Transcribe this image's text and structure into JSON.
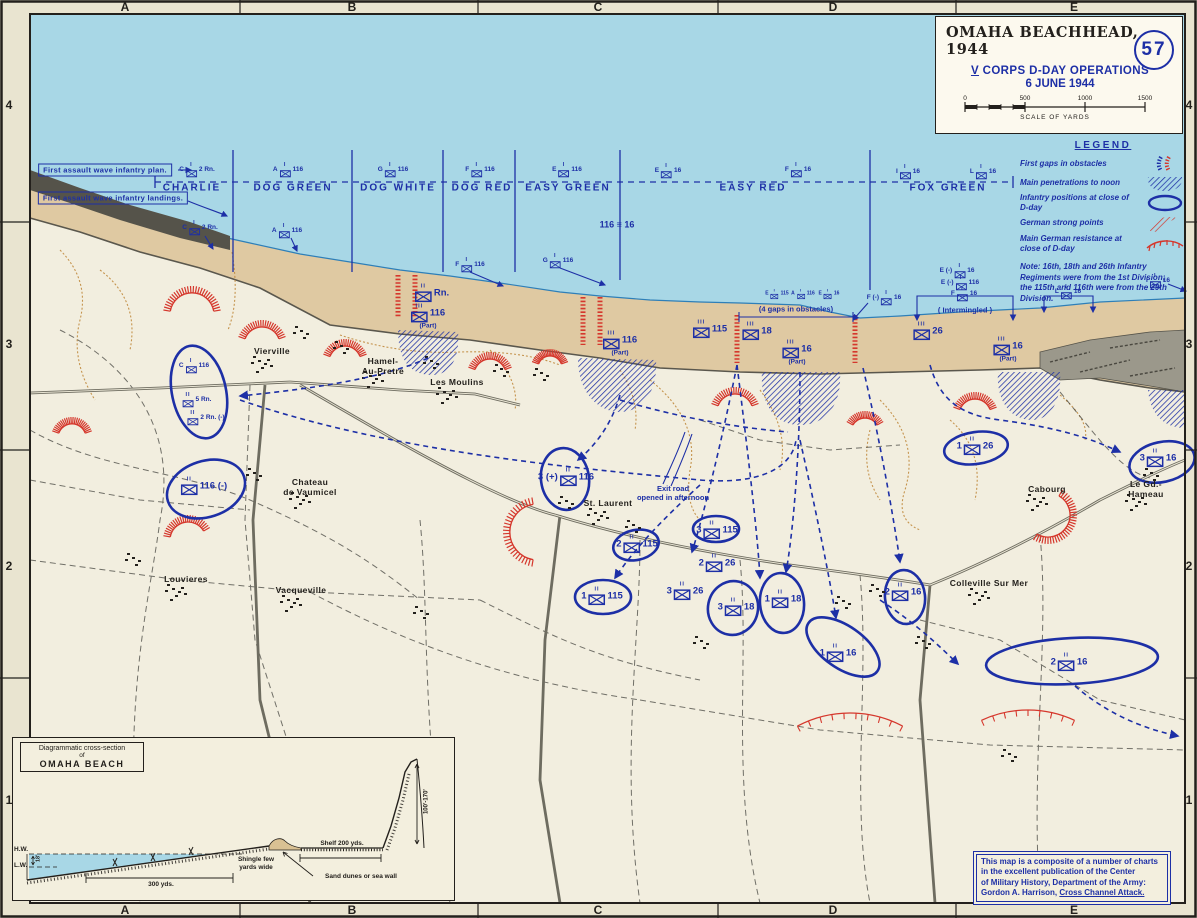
{
  "title_box": {
    "title": "OMAHA BEACHHEAD, 1944",
    "map_number": "57",
    "subtitle_v": "V",
    "subtitle_rest": " CORPS D-DAY OPERATIONS",
    "subtitle2": "6 JUNE 1944",
    "scale_ticks": [
      "0",
      "500",
      "1000",
      "1500"
    ],
    "scale_caption": "SCALE OF YARDS"
  },
  "legend": {
    "title": "LEGEND",
    "items": [
      {
        "label": "First gaps in obstacles",
        "symbol": "gap-icon"
      },
      {
        "label": "Main penetrations to noon",
        "symbol": "penetration-icon"
      },
      {
        "label": "Infantry positions at close of D-day",
        "symbol": "infantry-position-icon"
      },
      {
        "label": "German strong points",
        "symbol": "strongpoint-icon"
      },
      {
        "label": "Main German resistance at close of D-day",
        "symbol": "resistance-icon"
      }
    ],
    "note": "Note: 16th, 18th and 26th Infantry Regiments were from the 1st Division; the 115th and 116th were from the 29th Division."
  },
  "frame": {
    "grid_letters": [
      "A",
      "B",
      "C",
      "D",
      "E"
    ],
    "grid_letter_x": [
      125,
      352,
      598,
      833,
      1074
    ],
    "grid_numbers": [
      "4",
      "3",
      "2",
      "1"
    ],
    "grid_number_y": [
      105,
      344,
      566,
      800
    ]
  },
  "annotations": {
    "plan": {
      "text": "First assault wave infantry plan.",
      "x": 105,
      "y": 170
    },
    "landings": {
      "text": "First assault wave infantry landings.",
      "x": 113,
      "y": 198
    },
    "gaps": {
      "text": "(4 gaps in obstacles)",
      "x": 796,
      "y": 309
    },
    "intermingled": {
      "text": "( Intermingled )",
      "x": 965,
      "y": 310
    },
    "boundary_116_16": {
      "text": "116 ≡ 16",
      "x": 617,
      "y": 225
    },
    "exit_road": {
      "text": "Exit road\nopened in afternoon",
      "x": 673,
      "y": 493
    }
  },
  "sectors": {
    "label_y": 188,
    "items": [
      {
        "name": "CHARLIE",
        "x": 192
      },
      {
        "name": "DOG GREEN",
        "x": 293
      },
      {
        "name": "DOG WHITE",
        "x": 398
      },
      {
        "name": "DOG RED",
        "x": 482
      },
      {
        "name": "EASY GREEN",
        "x": 568
      },
      {
        "name": "EASY RED",
        "x": 753
      },
      {
        "name": "FOX GREEN",
        "x": 948
      }
    ],
    "boundaries": [
      233,
      352,
      443,
      515,
      620,
      870
    ]
  },
  "unit_markers": [
    {
      "x": 197,
      "y": 170,
      "l": "C",
      "r": "2 Rn.",
      "e": "I",
      "s": "sm"
    },
    {
      "x": 288,
      "y": 170,
      "l": "A",
      "r": "116",
      "e": "I",
      "s": "sm"
    },
    {
      "x": 393,
      "y": 170,
      "l": "G",
      "r": "116",
      "e": "I",
      "s": "sm"
    },
    {
      "x": 480,
      "y": 170,
      "l": "F",
      "r": "116",
      "e": "I",
      "s": "sm"
    },
    {
      "x": 567,
      "y": 170,
      "l": "E",
      "r": "116",
      "e": "I",
      "s": "sm"
    },
    {
      "x": 668,
      "y": 171,
      "l": "E",
      "r": "16",
      "e": "I",
      "s": "sm"
    },
    {
      "x": 798,
      "y": 170,
      "l": "F",
      "r": "16",
      "e": "I",
      "s": "sm"
    },
    {
      "x": 908,
      "y": 172,
      "l": "I",
      "r": "16",
      "e": "I",
      "s": "sm"
    },
    {
      "x": 983,
      "y": 172,
      "l": "L",
      "r": "16",
      "e": "I",
      "s": "sm"
    },
    {
      "x": 200,
      "y": 228,
      "l": "C",
      "r": "2 Rn.",
      "e": "I",
      "s": "sm"
    },
    {
      "x": 287,
      "y": 231,
      "l": "A",
      "r": "116",
      "e": "I",
      "s": "sm"
    },
    {
      "x": 470,
      "y": 265,
      "l": "F",
      "r": "116",
      "e": "I",
      "s": "sm"
    },
    {
      "x": 558,
      "y": 261,
      "l": "G",
      "r": "116",
      "e": "I",
      "s": "sm"
    },
    {
      "x": 777,
      "y": 294,
      "l": "E",
      "r": "115",
      "e": "I",
      "s": "xs"
    },
    {
      "x": 803,
      "y": 294,
      "l": "A",
      "r": "116",
      "e": "I",
      "s": "xs"
    },
    {
      "x": 829,
      "y": 294,
      "l": "E",
      "r": "16",
      "e": "I",
      "s": "xs"
    },
    {
      "x": 884,
      "y": 298,
      "l": "F (-)",
      "r": "16",
      "e": "I",
      "s": "sm"
    },
    {
      "x": 957,
      "y": 271,
      "l": "E (-)",
      "r": "16",
      "e": "I",
      "s": "sm"
    },
    {
      "x": 960,
      "y": 283,
      "l": "E (-)",
      "r": "116",
      "e": "I",
      "s": "sm"
    },
    {
      "x": 964,
      "y": 294,
      "l": "F",
      "r": "16",
      "e": "I",
      "s": "sm"
    },
    {
      "x": 1068,
      "y": 292,
      "l": "L",
      "r": "16",
      "e": "I",
      "s": "sm"
    },
    {
      "x": 1158,
      "y": 281,
      "l": "I",
      "r": "16",
      "e": "I",
      "s": "sm"
    },
    {
      "x": 432,
      "y": 293,
      "l": "",
      "r": "Rn.",
      "e": "II",
      "s": "md"
    },
    {
      "x": 428,
      "y": 317,
      "l": "",
      "r": "116",
      "e": "III",
      "sub": "(Part)",
      "s": "md"
    },
    {
      "x": 620,
      "y": 344,
      "l": "",
      "r": "116",
      "e": "III",
      "sub": "(Part)",
      "s": "md"
    },
    {
      "x": 710,
      "y": 329,
      "l": "",
      "r": "115",
      "e": "III",
      "s": "md"
    },
    {
      "x": 757,
      "y": 331,
      "l": "",
      "r": "18",
      "e": "III",
      "s": "md"
    },
    {
      "x": 797,
      "y": 353,
      "l": "",
      "r": "16",
      "e": "III",
      "sub": "(Part)",
      "s": "md"
    },
    {
      "x": 928,
      "y": 331,
      "l": "",
      "r": "26",
      "e": "III",
      "s": "md"
    },
    {
      "x": 1008,
      "y": 350,
      "l": "",
      "r": "16",
      "e": "III",
      "sub": "(Part)",
      "s": "md"
    },
    {
      "x": 717,
      "y": 563,
      "l": "2",
      "r": "26",
      "e": "II",
      "s": "md"
    },
    {
      "x": 685,
      "y": 591,
      "l": "3",
      "r": "26",
      "e": "II",
      "s": "md"
    }
  ],
  "ellipse_units": [
    {
      "x": 194,
      "y": 366,
      "l": "C",
      "r": "116",
      "e": "I",
      "s": "sm",
      "ellipse": {
        "cx": 199,
        "cy": 392,
        "rx": 27,
        "ry": 47,
        "rot": -12
      }
    },
    {
      "x": 197,
      "y": 400,
      "l": "",
      "r": "5 Rn.",
      "e": "II",
      "s": "sm"
    },
    {
      "x": 206,
      "y": 418,
      "l": "",
      "r": "2 Rn. (-)",
      "e": "II",
      "s": "sm"
    },
    {
      "x": 204,
      "y": 486,
      "l": "",
      "r": "116 (-)",
      "e": "II",
      "s": "md",
      "ellipse": {
        "cx": 206,
        "cy": 489,
        "rx": 40,
        "ry": 28,
        "rot": -18
      }
    },
    {
      "x": 566,
      "y": 477,
      "l": "3 (+)",
      "r": "116",
      "e": "II",
      "s": "md",
      "ellipse": {
        "cx": 565,
        "cy": 479,
        "rx": 24,
        "ry": 31,
        "rot": -8
      }
    },
    {
      "x": 637,
      "y": 544,
      "l": "2",
      "r": "115",
      "e": "II",
      "s": "md",
      "ellipse": {
        "cx": 636,
        "cy": 545,
        "rx": 23,
        "ry": 15,
        "rot": -12
      }
    },
    {
      "x": 602,
      "y": 596,
      "l": "1",
      "r": "115",
      "e": "II",
      "s": "md",
      "ellipse": {
        "cx": 603,
        "cy": 597,
        "rx": 28,
        "ry": 17,
        "rot": 0
      }
    },
    {
      "x": 717,
      "y": 530,
      "l": "3",
      "r": "115",
      "e": "II",
      "s": "md",
      "ellipse": {
        "cx": 716,
        "cy": 529,
        "rx": 23,
        "ry": 13,
        "rot": 0
      }
    },
    {
      "x": 736,
      "y": 607,
      "l": "3",
      "r": "18",
      "e": "II",
      "s": "md",
      "ellipse": {
        "cx": 733,
        "cy": 608,
        "rx": 25,
        "ry": 27,
        "rot": 12
      }
    },
    {
      "x": 783,
      "y": 599,
      "l": "1",
      "r": "18",
      "e": "II",
      "s": "md",
      "ellipse": {
        "cx": 782,
        "cy": 603,
        "rx": 22,
        "ry": 30,
        "rot": -5
      }
    },
    {
      "x": 838,
      "y": 653,
      "l": "1",
      "r": "16",
      "e": "II",
      "s": "md",
      "ellipse": {
        "cx": 843,
        "cy": 647,
        "rx": 42,
        "ry": 21,
        "rot": 35
      }
    },
    {
      "x": 903,
      "y": 592,
      "l": "2",
      "r": "16",
      "e": "II",
      "s": "md",
      "ellipse": {
        "cx": 905,
        "cy": 597,
        "rx": 20,
        "ry": 27,
        "rot": -6
      }
    },
    {
      "x": 975,
      "y": 446,
      "l": "1",
      "r": "26",
      "e": "II",
      "s": "md",
      "ellipse": {
        "cx": 976,
        "cy": 448,
        "rx": 32,
        "ry": 16,
        "rot": -8
      }
    },
    {
      "x": 1158,
      "y": 458,
      "l": "3",
      "r": "16",
      "e": "II",
      "s": "md",
      "ellipse": {
        "cx": 1162,
        "cy": 462,
        "rx": 33,
        "ry": 20,
        "rot": -12
      }
    },
    {
      "x": 1069,
      "y": 662,
      "l": "2",
      "r": "16",
      "e": "II",
      "s": "md",
      "ellipse": {
        "cx": 1072,
        "cy": 661,
        "rx": 86,
        "ry": 23,
        "rot": -3
      }
    }
  ],
  "towns": [
    {
      "name": "Vierville",
      "x": 272,
      "y": 352
    },
    {
      "name": "Hamel-\nAu-Pretre",
      "x": 383,
      "y": 367
    },
    {
      "name": "Les Moulins",
      "x": 457,
      "y": 383
    },
    {
      "name": "St. Laurent",
      "x": 608,
      "y": 504
    },
    {
      "name": "Chateau\nde Vaumicel",
      "x": 310,
      "y": 488
    },
    {
      "name": "Louvieres",
      "x": 186,
      "y": 580
    },
    {
      "name": "Vacqueville",
      "x": 301,
      "y": 591
    },
    {
      "name": "Colleville Sur Mer",
      "x": 989,
      "y": 584
    },
    {
      "name": "Cabourg",
      "x": 1047,
      "y": 490
    },
    {
      "name": "Le Gd.- Hameau",
      "x": 1146,
      "y": 490
    }
  ],
  "cross_section": {
    "box_line1": "Diagrammatic cross-section",
    "box_line2": "of",
    "box_line3": "OMAHA BEACH",
    "hw": "H.W.",
    "lw": "L.W.",
    "tide": "18'",
    "beach_width": "300 yds.",
    "shingle": "Shingle few yards wide",
    "dunes": "Sand dunes or sea wall",
    "shelf": "Shelf 200 yds.",
    "cliff": "100'-170'"
  },
  "source_note": {
    "line1": "This map is a composite of a number of charts",
    "line2": "in the excellent publication of the Center",
    "line3": "of Military History, Department of the Army:",
    "line4_prefix": "Gordon A. Harrison, ",
    "line4_underlined": "Cross Channel Attack."
  },
  "colors": {
    "sea": "#a8d7e6",
    "sand": "#dfc9a2",
    "land": "#f2eedf",
    "ink_blue": "#1d2fa6",
    "ink_red": "#d5372c"
  }
}
